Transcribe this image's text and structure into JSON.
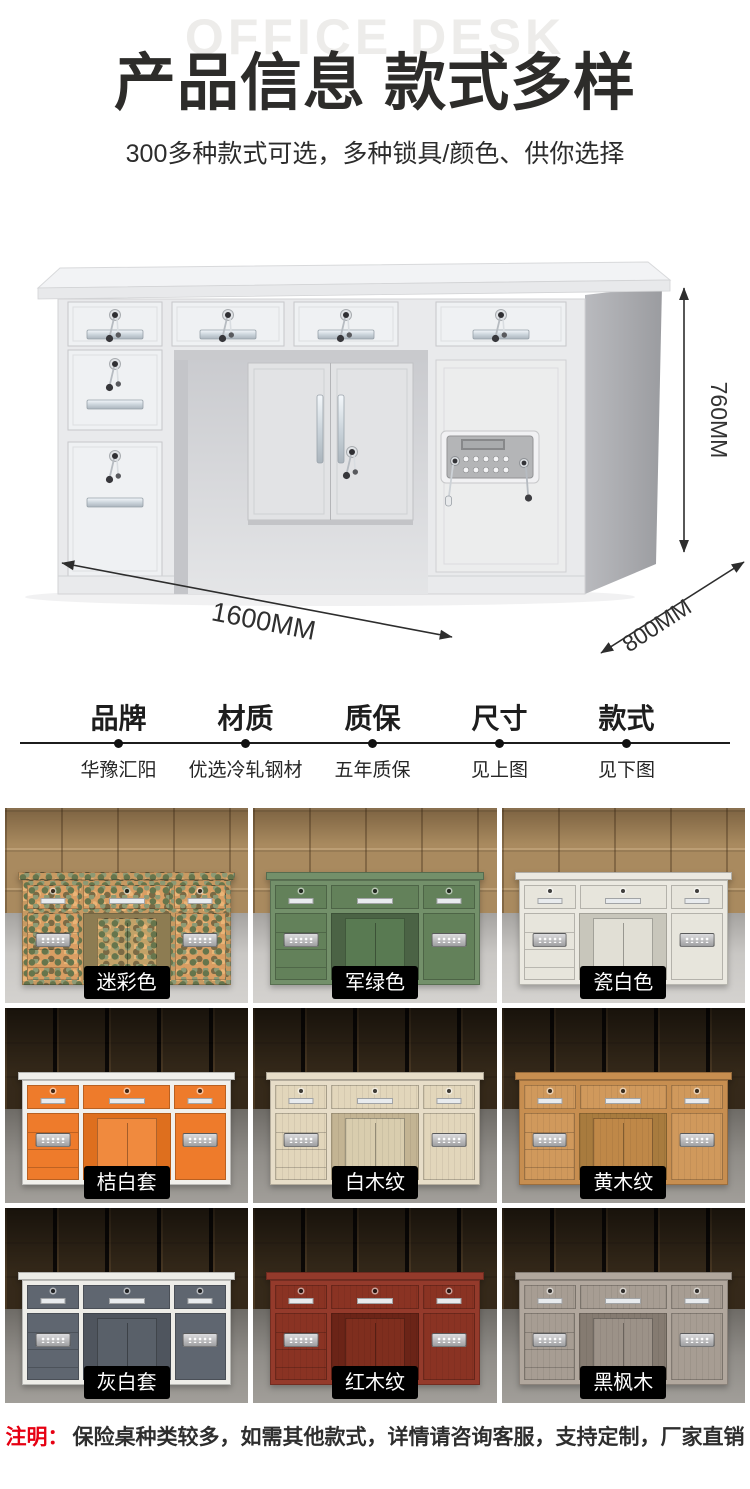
{
  "page": {
    "watermark": "OFFICE DESK",
    "title": "产品信息 款式多样",
    "subtitle": "300多种款式可选，多种锁具/颜色、供你选择"
  },
  "hero": {
    "height_label": "760MM",
    "width_label": "1600MM",
    "depth_label": "800MM"
  },
  "specs": {
    "columns": [
      {
        "label": "品牌",
        "value": "华豫汇阳"
      },
      {
        "label": "材质",
        "value": "优选冷轧钢材"
      },
      {
        "label": "质保",
        "value": "五年质保"
      },
      {
        "label": "尺寸",
        "value": "见上图"
      },
      {
        "label": "款式",
        "value": "见下图"
      }
    ]
  },
  "variants": [
    {
      "label": "迷彩色",
      "scene": "day",
      "colors": {
        "frame": "#c89a62",
        "panel": "#d99e63",
        "knee": "#8d7c52",
        "inner": "#c2a268"
      }
    },
    {
      "label": "军绿色",
      "scene": "day",
      "colors": {
        "frame": "#73906a",
        "panel": "#63815a",
        "knee": "#4b6345",
        "inner": "#597a52"
      }
    },
    {
      "label": "瓷白色",
      "scene": "day",
      "colors": {
        "frame": "#ebe9e1",
        "panel": "#e7e5dc",
        "knee": "#c8c6bb",
        "inner": "#e1dfd5"
      }
    },
    {
      "label": "桔白套",
      "scene": "night",
      "colors": {
        "frame": "#f1f0ec",
        "panel": "#ee7b2b",
        "knee": "#de6f1e",
        "inner": "#f08a3e"
      }
    },
    {
      "label": "白木纹",
      "scene": "night",
      "colors": {
        "frame": "#e7ddc8",
        "panel": "#e2d6bb",
        "knee": "#c3b493",
        "inner": "#d9cdae"
      }
    },
    {
      "label": "黄木纹",
      "scene": "night",
      "colors": {
        "frame": "#c78e50",
        "panel": "#d0995c",
        "knee": "#a87b3e",
        "inner": "#bf8848"
      }
    },
    {
      "label": "灰白套",
      "scene": "night",
      "colors": {
        "frame": "#eeede8",
        "panel": "#5f6670",
        "knee": "#4f555e",
        "inner": "#596069"
      }
    },
    {
      "label": "红木纹",
      "scene": "night",
      "colors": {
        "frame": "#943a2b",
        "panel": "#8a3323",
        "knee": "#6b2417",
        "inner": "#7f2e1e"
      }
    },
    {
      "label": "黑枫木",
      "scene": "night",
      "colors": {
        "frame": "#b1a79d",
        "panel": "#a79d93",
        "knee": "#857b71",
        "inner": "#9c9288"
      }
    }
  ],
  "note": {
    "prefix": "注明：",
    "text": "保险桌种类较多，如需其他款式，详情请咨询客服，支持定制，厂家直销"
  },
  "colors": {
    "accent_red": "#e60012",
    "title_text": "#2d2c2a",
    "watermark_text": "#edecea",
    "variant_label_bg": "#000000",
    "variant_label_text": "#ffffff",
    "desk_body": "#e9eaec",
    "desk_side": "#a6a7ab"
  }
}
